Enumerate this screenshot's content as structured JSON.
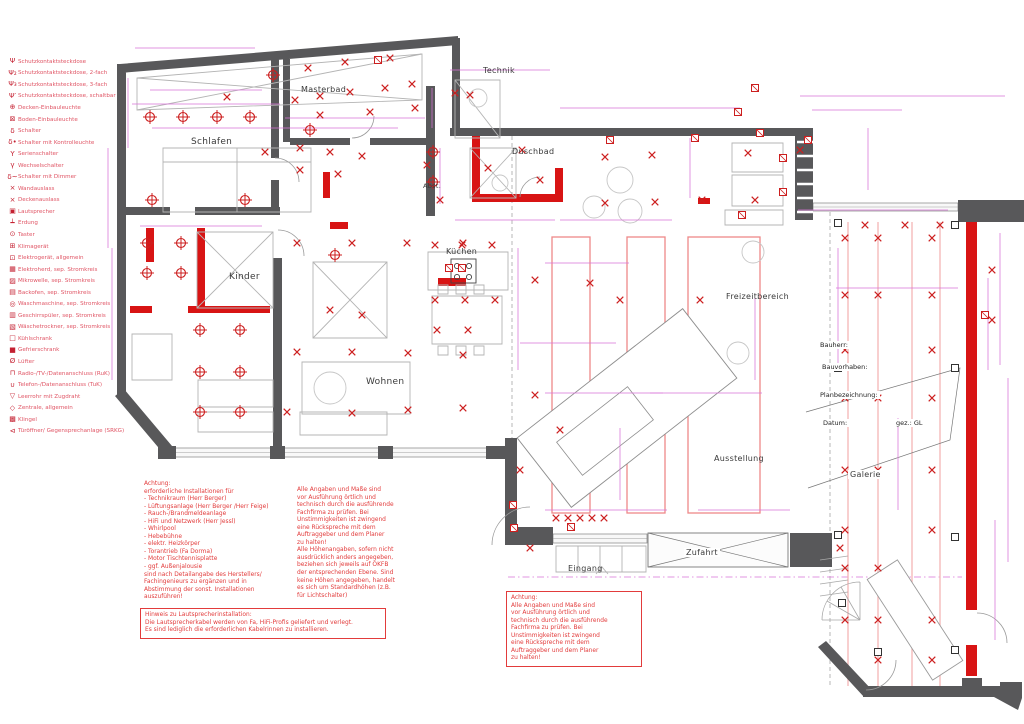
{
  "colors": {
    "wall_gray": "#58585a",
    "new_wall_red": "#d81414",
    "symbol_red": "#cc1f1f",
    "dimension_magenta": "#d873d8",
    "note_red": "#e23b3b",
    "legend_pink": "#e05565",
    "light_red_outline": "#ee8888"
  },
  "legend": {
    "items": [
      {
        "icon": "Ψ",
        "label": "Schutzkontaktsteckdose"
      },
      {
        "icon": "Ψ₂",
        "label": "Schutzkontaktsteckdose, 2-fach"
      },
      {
        "icon": "Ψ₃",
        "label": "Schutzkontaktsteckdose, 3-fach"
      },
      {
        "icon": "Ψ′",
        "label": "Schutzkontaktsteckdose, schaltbar"
      },
      {
        "icon": "⊕",
        "label": "Decken-Einbauleuchte"
      },
      {
        "icon": "⊠",
        "label": "Boden-Einbauleuchte"
      },
      {
        "icon": "δ",
        "label": "Schalter"
      },
      {
        "icon": "δ•",
        "label": "Schalter mit Kontrolleuchte"
      },
      {
        "icon": "Υ",
        "label": "Serienschalter"
      },
      {
        "icon": "γ",
        "label": "Wechselschalter"
      },
      {
        "icon": "δ~",
        "label": "Schalter mit Dimmer"
      },
      {
        "icon": "×",
        "label": "Wandauslass"
      },
      {
        "icon": "×",
        "label": "Deckenauslass"
      },
      {
        "icon": "▣",
        "label": "Lautsprecher"
      },
      {
        "icon": "┷",
        "label": "Erdung"
      },
      {
        "icon": "⊙",
        "label": "Taster"
      },
      {
        "icon": "⊞",
        "label": "Klimagerät"
      },
      {
        "icon": "⊡",
        "label": "Elektrogerät, allgemein"
      },
      {
        "icon": "▦",
        "label": "Elektroherd, sep. Stromkreis"
      },
      {
        "icon": "▨",
        "label": "Mikrowelle, sep. Stromkreis"
      },
      {
        "icon": "▤",
        "label": "Backofen, sep. Stromkreis"
      },
      {
        "icon": "◎",
        "label": "Waschmaschine, sep. Stromkreis"
      },
      {
        "icon": "▥",
        "label": "Geschirrspüler, sep. Stromkreis"
      },
      {
        "icon": "▧",
        "label": "Wäschetrockner, sep. Stromkreis"
      },
      {
        "icon": "□",
        "label": "Kühlschrank"
      },
      {
        "icon": "■",
        "label": "Gefrierschrank"
      },
      {
        "icon": "Ø",
        "label": "Lüfter"
      },
      {
        "icon": "⊓",
        "label": "Radio-/TV-/Datenanschluss (RuK)"
      },
      {
        "icon": "∪",
        "label": "Telefon-/Datenanschluss (TuK)"
      },
      {
        "icon": "▽",
        "label": "Leerrohr mit Zugdraht"
      },
      {
        "icon": "◇",
        "label": "Zentrale, allgemein"
      },
      {
        "icon": "▩",
        "label": "Klingel"
      },
      {
        "icon": "⊲",
        "label": "Türöffner/ Gegensprechanlage (SRKG)"
      }
    ]
  },
  "rooms": [
    {
      "label": "Technik"
    },
    {
      "label": "Masterbad"
    },
    {
      "label": "Schlafen"
    },
    {
      "label": "Duschbad"
    },
    {
      "label": "Abst."
    },
    {
      "label": "Kinder"
    },
    {
      "label": "Küchen"
    },
    {
      "label": "Wohnen"
    },
    {
      "label": "Freizeitbereich"
    },
    {
      "label": "Ausstellung"
    },
    {
      "label": "Galerie"
    },
    {
      "label": "Eingang"
    },
    {
      "label": "Zufahrt"
    }
  ],
  "title_block": {
    "bauherr": "Bauherr:",
    "bauvorhaben": "Bauvorhaben:",
    "planbezeichnung": "Planbezeichnung:",
    "datum": "Datum:",
    "gez": "gez.: GL"
  },
  "notes": {
    "installations": "Achtung:\nerforderliche Installationen für\n- Technikraum (Herr Berger)\n- Lüftungsanlage (Herr Berger /Herr Feige)\n- Rauch-/Brandmeldeanlage\n- HiFi und Netzwerk (Herr Jessl)\n- Whirlpool\n- Hebebühne\n- elektr. Heizkörper\n- Torantrieb (Fa Dorma)\n- Motor Tischtennisplatte\n- ggf. Außenjalousie\nsind nach Detailangabe des Herstellers/\nFachingenieurs zu ergänzen und in\nAbstimmung der sonst. Installationen\nauszuführen!",
    "measures": "Alle Angaben und Maße sind\nvor Ausführung örtlich und\ntechnisch durch die ausführende\nFachfirma zu prüfen. Bei\nUnstimmigkeiten ist zwingend\neine Rückspreche mit dem\nAuftraggeber und dem Planer\nzu halten!\nAlle Höhenangaben, sofern nicht\nausdrücklich anders angegeben,\nbeziehen sich jeweils auf OKFB\nder entsprechenden Ebene. Sind\nkeine Höhen angegeben, handelt\nes sich um Standardhöhen (z.B.\nfür Lichtschalter)",
    "speaker": "Hinweis zu Lautsprecherinstallation:\nDie Lautsprecherkabel werden von Fa, HiFi-Profis geliefert und verlegt.\nEs sind lediglich die erforderlichen Kabelrinnen zu installieren.",
    "attention": "Achtung:\nAlle Angaben und Maße sind\nvor Ausführung örtlich und\ntechnisch durch die ausführende\nFachfirma zu prüfen. Bei\nUnstimmigkeiten ist zwingend\neine Rückspreche mit dem\nAuftraggeber und dem Planer\nzu halten!"
  },
  "plan_graphics": {
    "ceiling_lights": [
      [
        150,
        117
      ],
      [
        183,
        117
      ],
      [
        217,
        117
      ],
      [
        250,
        117
      ],
      [
        273,
        75
      ],
      [
        152,
        200
      ],
      [
        245,
        200
      ],
      [
        147,
        243
      ],
      [
        181,
        243
      ],
      [
        147,
        273
      ],
      [
        181,
        273
      ],
      [
        200,
        330
      ],
      [
        240,
        330
      ],
      [
        200,
        372
      ],
      [
        240,
        372
      ],
      [
        200,
        412
      ],
      [
        240,
        412
      ],
      [
        433,
        152
      ],
      [
        433,
        182
      ],
      [
        335,
        255
      ],
      [
        310,
        130
      ]
    ],
    "x_marks": [
      [
        295,
        100
      ],
      [
        320,
        96
      ],
      [
        350,
        92
      ],
      [
        385,
        88
      ],
      [
        412,
        84
      ],
      [
        455,
        93
      ],
      [
        227,
        97
      ],
      [
        300,
        148
      ],
      [
        330,
        152
      ],
      [
        362,
        156
      ],
      [
        300,
        170
      ],
      [
        338,
        174
      ],
      [
        265,
        152
      ],
      [
        308,
        68
      ],
      [
        345,
        62
      ],
      [
        390,
        58
      ],
      [
        415,
        108
      ],
      [
        370,
        112
      ],
      [
        320,
        115
      ],
      [
        470,
        95
      ],
      [
        488,
        168
      ],
      [
        522,
        150
      ],
      [
        540,
        180
      ],
      [
        427,
        165
      ],
      [
        440,
        200
      ],
      [
        435,
        245
      ],
      [
        462,
        245
      ],
      [
        492,
        245
      ],
      [
        435,
        300
      ],
      [
        465,
        300
      ],
      [
        495,
        300
      ],
      [
        437,
        330
      ],
      [
        468,
        330
      ],
      [
        297,
        243
      ],
      [
        352,
        243
      ],
      [
        407,
        243
      ],
      [
        463,
        243
      ],
      [
        297,
        352
      ],
      [
        352,
        352
      ],
      [
        408,
        353
      ],
      [
        463,
        355
      ],
      [
        287,
        412
      ],
      [
        352,
        413
      ],
      [
        408,
        410
      ],
      [
        463,
        408
      ],
      [
        330,
        310
      ],
      [
        362,
        315
      ],
      [
        605,
        157
      ],
      [
        652,
        155
      ],
      [
        748,
        153
      ],
      [
        800,
        150
      ],
      [
        605,
        203
      ],
      [
        655,
        202
      ],
      [
        702,
        200
      ],
      [
        755,
        200
      ],
      [
        535,
        280
      ],
      [
        590,
        283
      ],
      [
        535,
        395
      ],
      [
        560,
        430
      ],
      [
        520,
        470
      ],
      [
        620,
        300
      ],
      [
        700,
        300
      ],
      [
        556,
        518
      ],
      [
        568,
        518
      ],
      [
        580,
        518
      ],
      [
        592,
        518
      ],
      [
        604,
        518
      ],
      [
        530,
        548
      ],
      [
        840,
        548
      ],
      [
        845,
        238
      ],
      [
        878,
        238
      ],
      [
        932,
        238
      ],
      [
        845,
        295
      ],
      [
        878,
        295
      ],
      [
        932,
        295
      ],
      [
        845,
        350
      ],
      [
        932,
        350
      ],
      [
        845,
        398
      ],
      [
        878,
        398
      ],
      [
        932,
        398
      ],
      [
        845,
        470
      ],
      [
        878,
        470
      ],
      [
        932,
        470
      ],
      [
        845,
        530
      ],
      [
        932,
        530
      ],
      [
        845,
        568
      ],
      [
        878,
        568
      ],
      [
        845,
        620
      ],
      [
        878,
        620
      ],
      [
        932,
        620
      ],
      [
        878,
        660
      ],
      [
        932,
        660
      ],
      [
        992,
        270
      ],
      [
        992,
        320
      ],
      [
        865,
        225
      ],
      [
        905,
        225
      ],
      [
        940,
        225
      ]
    ],
    "device_boxes": [
      [
        378,
        60
      ],
      [
        755,
        88
      ],
      [
        738,
        112
      ],
      [
        783,
        158
      ],
      [
        783,
        192
      ],
      [
        742,
        215
      ],
      [
        449,
        268
      ],
      [
        462,
        268
      ],
      [
        513,
        505
      ],
      [
        514,
        528
      ],
      [
        571,
        527
      ],
      [
        985,
        315
      ],
      [
        760,
        133
      ],
      [
        610,
        140
      ],
      [
        695,
        138
      ],
      [
        808,
        140
      ]
    ],
    "dims_h": [
      [
        135,
        48,
        120
      ],
      [
        150,
        90,
        112
      ],
      [
        132,
        104,
        148
      ],
      [
        285,
        118,
        140
      ],
      [
        450,
        70,
        100
      ],
      [
        560,
        108,
        180
      ],
      [
        800,
        96,
        205
      ],
      [
        812,
        110,
        90
      ],
      [
        455,
        220,
        100
      ],
      [
        560,
        220,
        112
      ],
      [
        798,
        210,
        150
      ],
      [
        545,
        263,
        84
      ],
      [
        140,
        226,
        122
      ],
      [
        152,
        128,
        246
      ],
      [
        545,
        393,
        118
      ],
      [
        650,
        393,
        112
      ],
      [
        520,
        343,
        96
      ],
      [
        836,
        288,
        122
      ],
      [
        545,
        510,
        122
      ],
      [
        698,
        510,
        92
      ]
    ],
    "dims_v": [
      [
        128,
        78,
        70
      ],
      [
        108,
        148,
        100
      ],
      [
        112,
        248,
        132
      ],
      [
        440,
        148,
        56
      ],
      [
        1000,
        233,
        132
      ],
      [
        1008,
        378,
        184
      ],
      [
        988,
        278,
        92
      ],
      [
        518,
        248,
        122
      ],
      [
        432,
        88,
        40
      ],
      [
        838,
        248,
        120
      ],
      [
        898,
        418,
        92
      ],
      [
        868,
        128,
        62
      ],
      [
        690,
        138,
        60
      ],
      [
        755,
        298,
        82
      ],
      [
        620,
        428,
        72
      ],
      [
        995,
        520,
        120
      ]
    ]
  }
}
